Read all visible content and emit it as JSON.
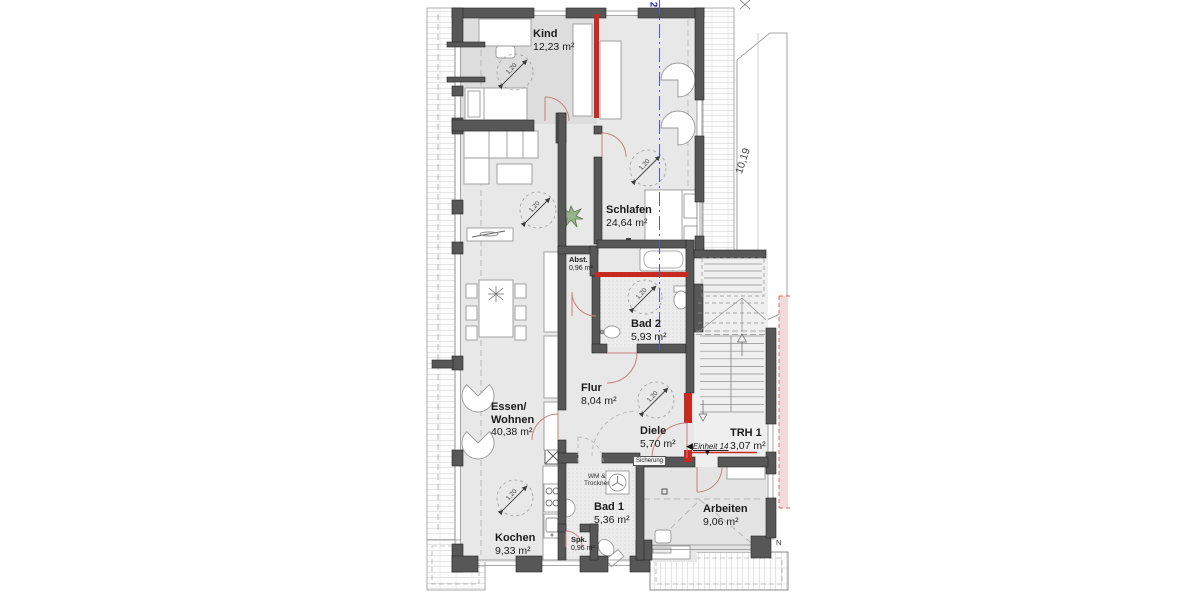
{
  "drawing": {
    "type": "apartment-floor-plan",
    "floor": "attic unit"
  },
  "rooms": [
    {
      "id": "kind",
      "name": "Kind",
      "area": "12,23 m²"
    },
    {
      "id": "schlafen",
      "name": "Schlafen",
      "area": "24,64 m²"
    },
    {
      "id": "abst",
      "name": "Abst.",
      "area": "0,96 m²"
    },
    {
      "id": "bad2",
      "name": "Bad 2",
      "area": "5,93 m²"
    },
    {
      "id": "flur",
      "name": "Flur",
      "area": "8,04 m²"
    },
    {
      "id": "diele",
      "name": "Diele",
      "area": "5,70 m²"
    },
    {
      "id": "essen_wohnen",
      "name_line1": "Essen/",
      "name_line2": "Wohnen",
      "area": "40,38 m²"
    },
    {
      "id": "kochen",
      "name": "Kochen",
      "area": "9,33 m²"
    },
    {
      "id": "bad1",
      "name": "Bad 1",
      "area": "5,36 m²"
    },
    {
      "id": "spk",
      "name": "Spk.",
      "area": "0,96 m²"
    },
    {
      "id": "arbeiten",
      "name": "Arbeiten",
      "area": "9,06 m²"
    },
    {
      "id": "trh",
      "name": "TRH 1",
      "area": "3,07 m²"
    }
  ],
  "annotations": {
    "unit_label": "Einheit 14",
    "sicherung": "Sicherung",
    "wm_line1": "WM &",
    "wm_line2": "Trockner",
    "knee_height": "1,20",
    "dim_right": "10,19",
    "section_mark": "2",
    "north_mark": "N",
    "entrance_arrow_left": "◀",
    "entrance_arrow_down": "▼"
  },
  "colors": {
    "wall": "#575757",
    "floor": "#e8e8e8",
    "new_wall_red": "#c72b20",
    "section_line_blue": "#5555c0",
    "neighbor_band_pink": "#f3d9d9",
    "plant_green": "#8fae80"
  }
}
